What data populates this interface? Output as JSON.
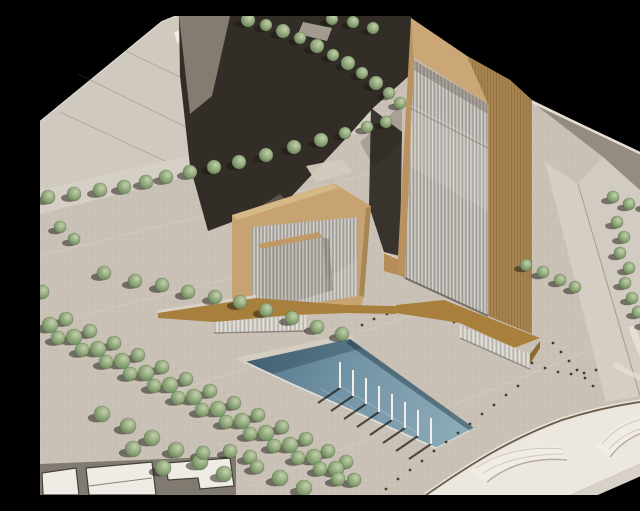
{
  "meta": {
    "width_px": 640,
    "height_px": 479,
    "kind": "photograph",
    "description": "Aerial photograph of an architectural scale model on a black studio backdrop: a tall ribbed-glass tower with timber-toned edges, a lower wedge-shaped office block, an angled timber podium, an L-shaped reflecting pool with a row of flagpoles, dotted bollard lines on the plaza, diagonal tree-lined streets, a curved highway interchange at lower right and cropped white massing blocks at lower left."
  },
  "palette": {
    "bg": "#000000",
    "board": "#c9c1b6",
    "boardLight": "#d8d1c8",
    "plateA": "#d0c9c0",
    "edgeHighlight": "#e4ded5",
    "streetDark": "#322d27",
    "streetLit": "#8d857a",
    "crosswalk": "#d3cabd",
    "roadStrip": "#d6cfc5",
    "rightParcel": "#d2cbc1",
    "grayWedge": "#948c81",
    "towerTanLight": "#cba777",
    "towerTanMid": "#b9925f",
    "towerTanDark": "#a8834f",
    "shellTan": "#c6a371",
    "glass": "#b3afa8",
    "glassShade": "#a6a29a",
    "podiumBrown": "#a97f3d",
    "podiumRib": "#cdc9c2",
    "linkTan": "#b58e58",
    "pool": "#7495a7",
    "poolShadow": "#54748a",
    "poolLight": "#8fadbb",
    "rim": "#e9e4dc",
    "ramp": "#ece7df",
    "rampFace": "#f1ede6",
    "rampShade": "#cfc7bb",
    "curb": "#6b5b47",
    "bollard": "#4a3c2d",
    "blockWhite": "#efece6",
    "poleWhite": "#f2efe9"
  },
  "scene": {
    "type": "Architectural scale model photograph",
    "background": "black studio backdrop",
    "tower": {
      "label": "main high-rise tower, ribbed glass curtain wall framed in timber-toned board, sloped roofline"
    },
    "podium_building": {
      "label": "lower office block with protruding sloped glass wedge"
    },
    "podium": {
      "label": "angled timber-toned podium band linking both buildings"
    },
    "reflecting_pool": {
      "label": "L-shaped reflecting pool",
      "flagpole_count": 8
    },
    "plaza": {
      "label": "stippled paved plaza with dotted bollard lines",
      "bollard_line_count": 3
    },
    "landscaping": {
      "label": "street tree rows and dense diagonal grove",
      "tree_count": 113
    },
    "roads": {
      "label": "shadowed avenue with crosswalks, tree-lined boulevard, curved interchange ramps"
    },
    "white_blocks": {
      "label": "neighbouring white massing blocks cropped by frame edge"
    }
  },
  "trees": {
    "positions": [
      [
        208,
        4,
        7
      ],
      [
        226,
        9,
        6
      ],
      [
        243,
        15,
        7
      ],
      [
        260,
        22,
        6
      ],
      [
        277,
        30,
        7
      ],
      [
        293,
        39,
        6
      ],
      [
        308,
        47,
        7
      ],
      [
        322,
        57,
        6
      ],
      [
        336,
        67,
        7
      ],
      [
        349,
        77,
        6
      ],
      [
        360,
        87,
        6
      ],
      [
        292,
        3,
        6
      ],
      [
        313,
        6,
        6
      ],
      [
        333,
        12,
        6
      ],
      [
        8,
        181,
        7
      ],
      [
        34,
        178,
        7
      ],
      [
        60,
        174,
        7
      ],
      [
        84,
        171,
        7
      ],
      [
        106,
        166,
        7
      ],
      [
        126,
        161,
        7
      ],
      [
        150,
        156,
        7
      ],
      [
        174,
        151,
        7
      ],
      [
        199,
        146,
        7
      ],
      [
        226,
        139,
        7
      ],
      [
        254,
        131,
        7
      ],
      [
        281,
        124,
        7
      ],
      [
        305,
        117,
        6
      ],
      [
        327,
        111,
        6
      ],
      [
        346,
        106,
        6
      ],
      [
        20,
        211,
        6
      ],
      [
        34,
        223,
        6
      ],
      [
        2,
        276,
        7
      ],
      [
        64,
        257,
        7
      ],
      [
        95,
        265,
        7
      ],
      [
        122,
        269,
        7
      ],
      [
        148,
        276,
        7
      ],
      [
        175,
        281,
        7
      ],
      [
        200,
        286,
        7
      ],
      [
        226,
        294,
        7
      ],
      [
        252,
        302,
        7
      ],
      [
        277,
        311,
        7
      ],
      [
        302,
        318,
        7
      ],
      [
        26,
        303,
        7
      ],
      [
        50,
        315,
        7
      ],
      [
        74,
        327,
        7
      ],
      [
        98,
        339,
        7
      ],
      [
        122,
        351,
        7
      ],
      [
        146,
        363,
        7
      ],
      [
        170,
        375,
        7
      ],
      [
        194,
        387,
        7
      ],
      [
        218,
        399,
        7
      ],
      [
        242,
        411,
        7
      ],
      [
        266,
        423,
        7
      ],
      [
        288,
        435,
        7
      ],
      [
        306,
        446,
        7
      ],
      [
        10,
        309,
        8
      ],
      [
        34,
        321,
        8
      ],
      [
        58,
        333,
        8
      ],
      [
        82,
        345,
        8
      ],
      [
        106,
        357,
        8
      ],
      [
        130,
        369,
        8
      ],
      [
        154,
        381,
        8
      ],
      [
        178,
        393,
        8
      ],
      [
        202,
        405,
        8
      ],
      [
        226,
        417,
        8
      ],
      [
        250,
        429,
        8
      ],
      [
        274,
        441,
        8
      ],
      [
        296,
        453,
        8
      ],
      [
        314,
        464,
        7
      ],
      [
        18,
        322,
        7
      ],
      [
        42,
        334,
        7
      ],
      [
        66,
        346,
        7
      ],
      [
        90,
        358,
        7
      ],
      [
        114,
        370,
        7
      ],
      [
        138,
        382,
        7
      ],
      [
        162,
        394,
        7
      ],
      [
        186,
        406,
        7
      ],
      [
        210,
        418,
        7
      ],
      [
        234,
        430,
        7
      ],
      [
        258,
        442,
        7
      ],
      [
        280,
        453,
        7
      ],
      [
        298,
        463,
        7
      ],
      [
        62,
        398,
        8
      ],
      [
        88,
        410,
        8
      ],
      [
        112,
        422,
        8
      ],
      [
        93,
        433,
        8
      ],
      [
        136,
        434,
        8
      ],
      [
        123,
        452,
        8
      ],
      [
        160,
        446,
        8
      ],
      [
        163,
        437,
        7
      ],
      [
        184,
        458,
        8
      ],
      [
        190,
        435,
        7
      ],
      [
        210,
        441,
        7
      ],
      [
        217,
        451,
        7
      ],
      [
        240,
        462,
        8
      ],
      [
        264,
        472,
        8
      ],
      [
        573,
        181,
        6
      ],
      [
        589,
        188,
        6
      ],
      [
        607,
        189,
        6
      ],
      [
        625,
        192,
        6
      ],
      [
        577,
        206,
        6
      ],
      [
        584,
        221,
        6
      ],
      [
        580,
        237,
        6
      ],
      [
        589,
        252,
        6
      ],
      [
        585,
        267,
        6
      ],
      [
        592,
        282,
        6
      ],
      [
        598,
        296,
        6
      ],
      [
        606,
        307,
        6
      ],
      [
        615,
        316,
        6
      ],
      [
        486,
        249,
        6
      ],
      [
        503,
        256,
        6
      ],
      [
        520,
        264,
        6
      ],
      [
        535,
        271,
        6
      ]
    ]
  },
  "flagpoles": {
    "height_px": 26,
    "tops": [
      [
        300,
        346
      ],
      [
        313,
        354
      ],
      [
        326,
        362
      ],
      [
        339,
        370
      ],
      [
        352,
        378
      ],
      [
        365,
        386
      ],
      [
        378,
        394
      ],
      [
        391,
        402
      ]
    ]
  },
  "bollards": {
    "lines": [
      [
        [
          322,
          309
        ],
        [
          334,
          303
        ],
        [
          347,
          298
        ],
        [
          360,
          295
        ],
        [
          374,
          294
        ],
        [
          388,
          296
        ],
        [
          401,
          300
        ],
        [
          414,
          306
        ],
        [
          427,
          313
        ],
        [
          440,
          320
        ],
        [
          453,
          327
        ],
        [
          466,
          334
        ],
        [
          479,
          341
        ],
        [
          492,
          347
        ],
        [
          505,
          352
        ],
        [
          518,
          356
        ],
        [
          531,
          358
        ],
        [
          544,
          357
        ],
        [
          556,
          354
        ]
      ],
      [
        [
          478,
          370
        ],
        [
          466,
          379
        ],
        [
          454,
          389
        ],
        [
          442,
          398
        ],
        [
          430,
          408
        ],
        [
          418,
          417
        ],
        [
          406,
          426
        ],
        [
          394,
          435
        ],
        [
          382,
          445
        ],
        [
          370,
          454
        ],
        [
          358,
          463
        ],
        [
          346,
          473
        ]
      ],
      [
        [
          513,
          327
        ],
        [
          521,
          336
        ],
        [
          529,
          345
        ],
        [
          537,
          354
        ],
        [
          545,
          362
        ],
        [
          553,
          370
        ]
      ]
    ]
  }
}
